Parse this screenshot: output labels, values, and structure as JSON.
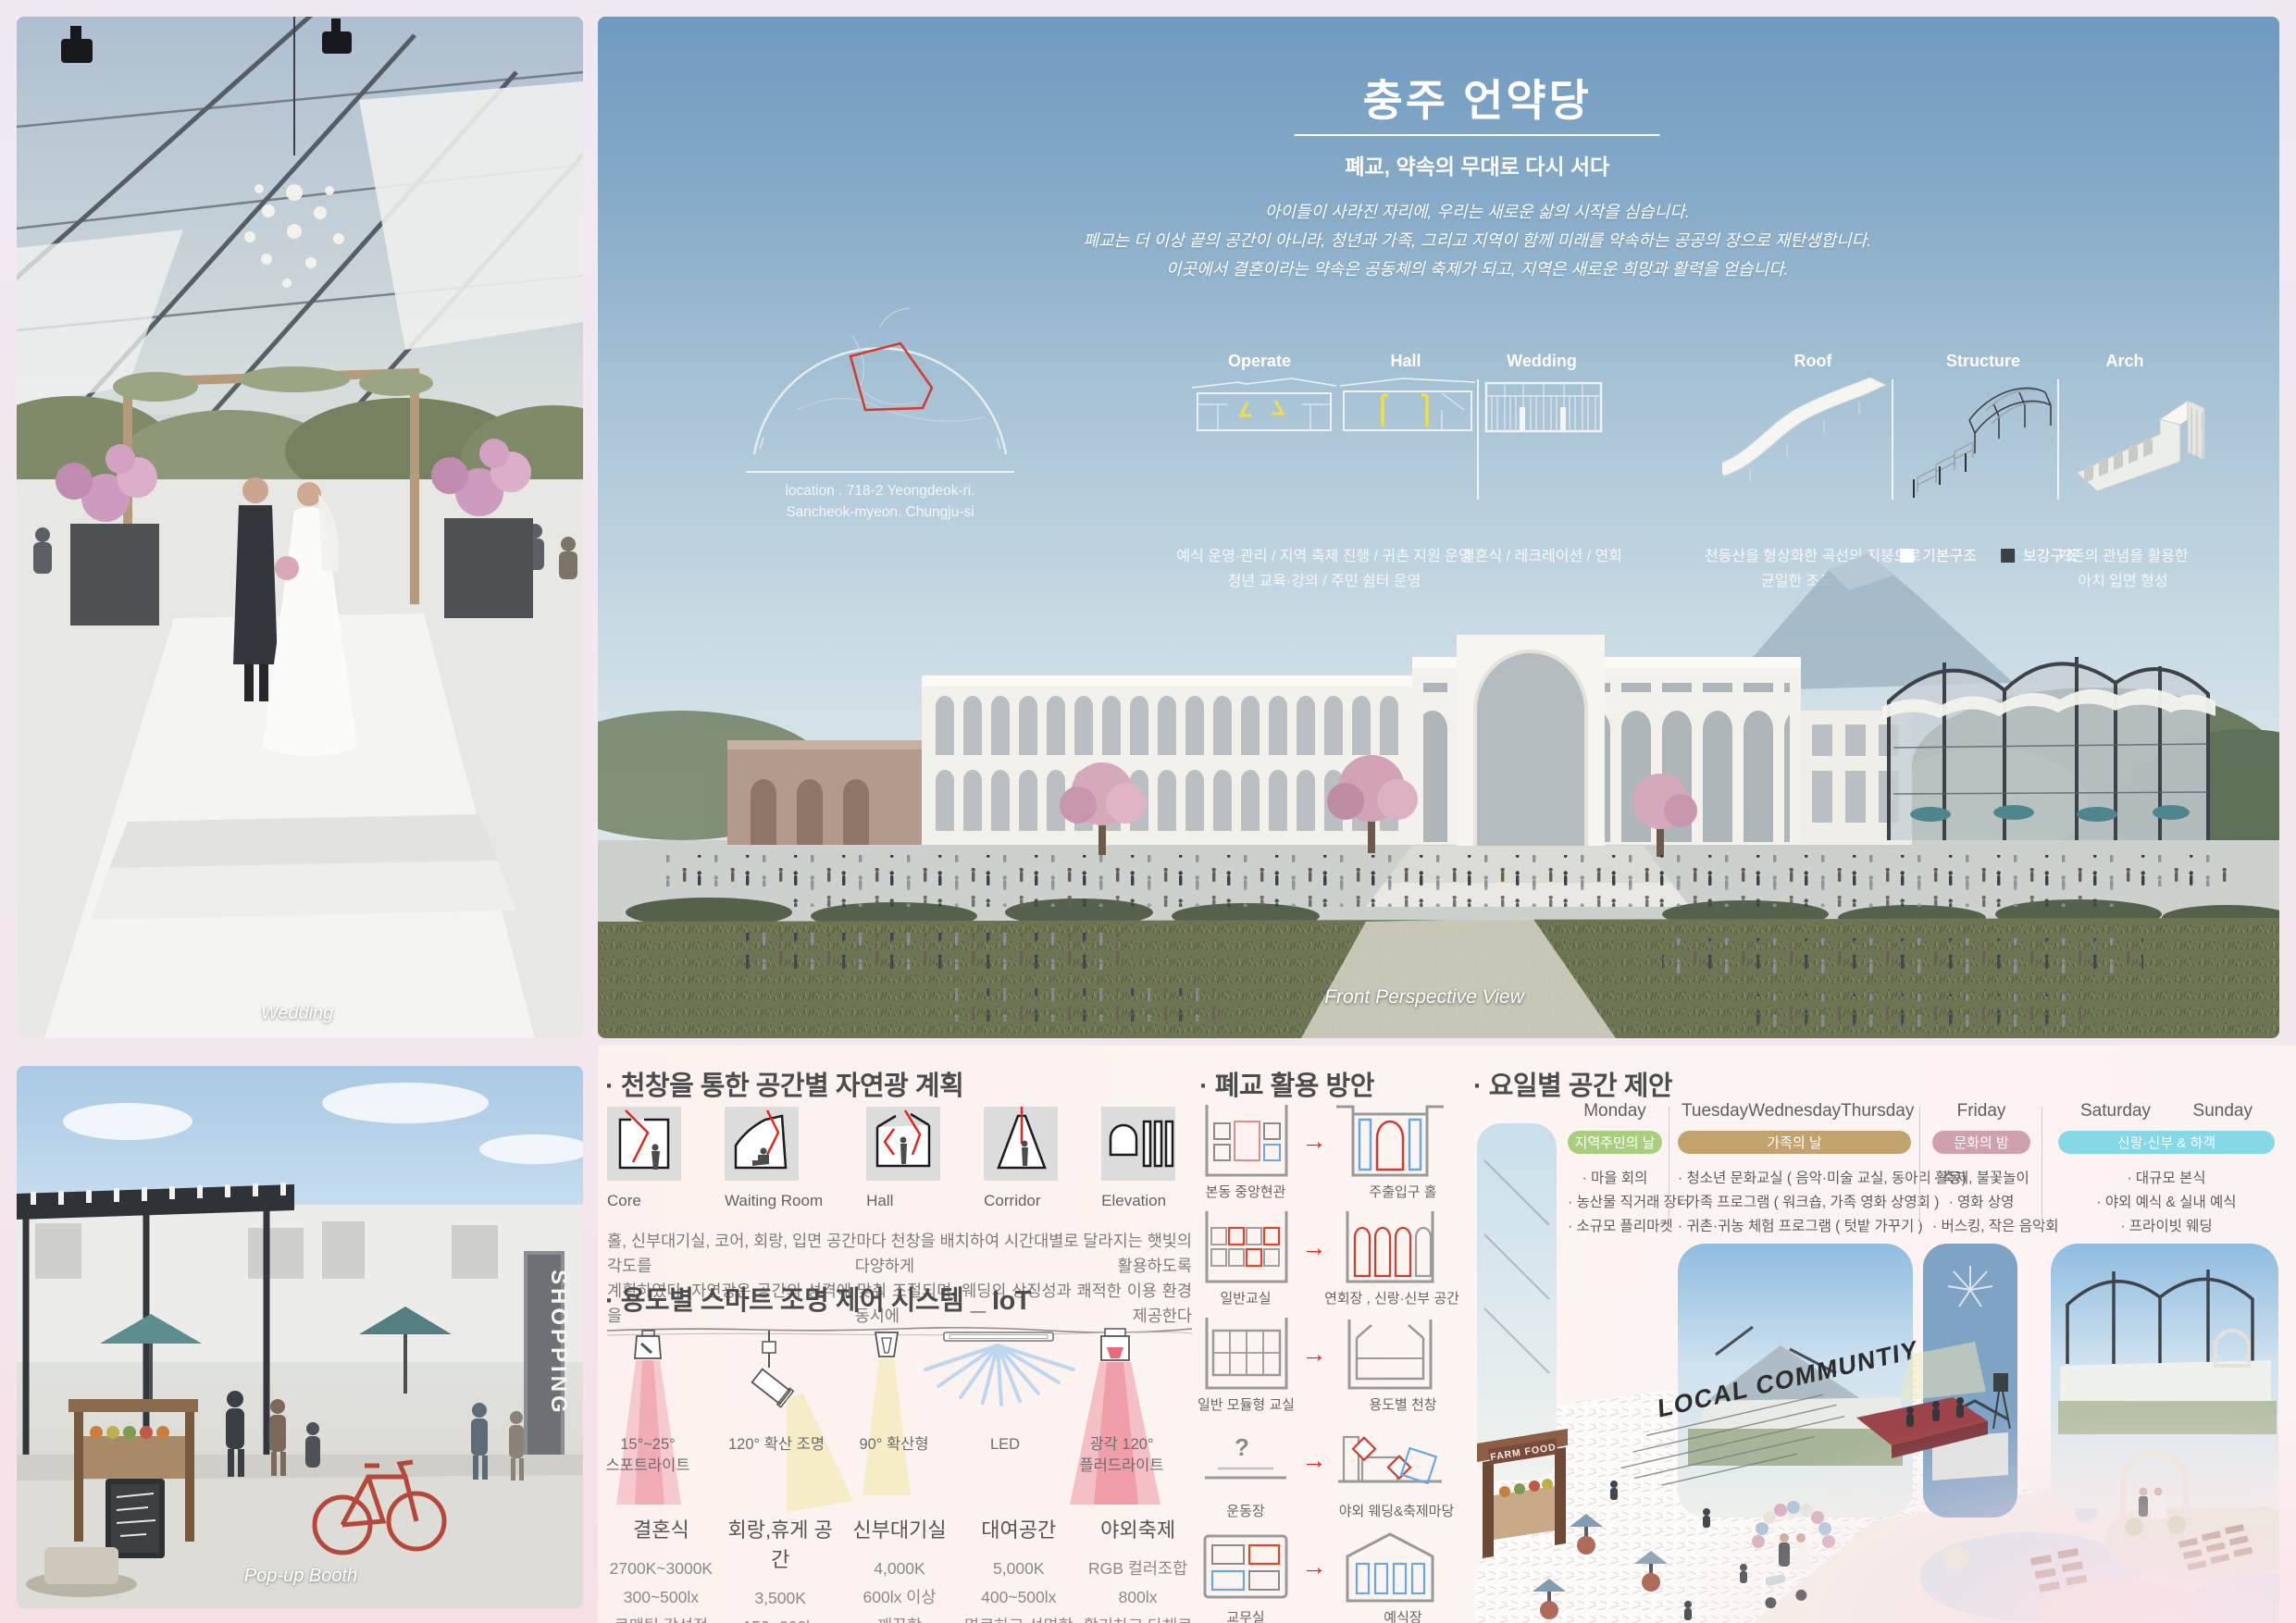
{
  "board": {
    "accent_colors": {
      "sky_blue": "#6f9ac0",
      "panel_pink": "#fcf1ee",
      "diagram_red": "#e8241c",
      "diagram_blue": "#6aa8e0",
      "highlight_yellow": "#f5e04a"
    }
  },
  "wedding_panel": {
    "caption": "Wedding"
  },
  "popup_panel": {
    "caption": "Pop-up Booth",
    "sign": "SHOPPING"
  },
  "hero": {
    "title": "충주 언약당",
    "subtitle": "폐교, 약속의 무대로 다시 서다",
    "intro": [
      "아이들이 사라진 자리에, 우리는 새로운 삶의 시작을 심습니다.",
      "폐교는 더 이상 끝의 공간이 아니라, 청년과 가족, 그리고 지역이 함께 미래를 약속하는 공공의 장으로 재탄생합니다.",
      "이곳에서 결혼이라는 약속은 공동체의 축제가 되고, 지역은 새로운 희망과 활력을 얻습니다."
    ],
    "location_line1": "location . 718-2 Yeongdeok-ri.",
    "location_line2": "Sancheok-myeon. Chungju-si",
    "program_labels": [
      "Operate",
      "Hall",
      "Wedding"
    ],
    "operate_hall_caption1": "예식 운영·관리 / 지역 축제 진행 / 귀촌 지원 운영",
    "operate_hall_caption2": "청년 교육·강의 / 주민 쉼터 운영",
    "wedding_caption": "결혼식 / 레크레이션 / 연회",
    "concept_labels": [
      "Roof",
      "Structure",
      "Arch"
    ],
    "roof_caption1": "천등산을 형상화한 곡선의 지붕으로",
    "roof_caption2": "균일한 조도 확보",
    "structure_legend": [
      "기본구조",
      "보강구조"
    ],
    "arch_caption1": "기존의 관념을 활용한",
    "arch_caption2": "아치 입면 형성",
    "view_caption": "Front Perspective View"
  },
  "daylight": {
    "heading": "· 천창을 통한 공간별 자연광 계획",
    "spaces": [
      "Core",
      "Waiting Room",
      "Hall",
      "Corridor",
      "Elevation"
    ],
    "para1": "홀, 신부대기실, 코어, 회랑, 입면 공간마다 천창을 배치하여 시간대별로 달라지는 햇빛의 각도를 다양하게 활용하도록",
    "para2": "계획하였다. 자연광은 공간의 성격에 맞춰 조절되며, 웨딩의 상징성과 쾌적한 이용 환경을 동시에 제공한다"
  },
  "iot": {
    "heading": "· 용도별 스마트 조명 제어 시스템 _ IoT",
    "fixtures": [
      {
        "line1": "15°~25°",
        "line2": "스포트라이트"
      },
      {
        "line1": "120° 확산 조명",
        "line2": ""
      },
      {
        "line1": "90° 확산형",
        "line2": ""
      },
      {
        "line1": "LED",
        "line2": ""
      },
      {
        "line1": "광각 120°",
        "line2": "플러드라이트"
      }
    ],
    "specs": [
      {
        "name": "결혼식",
        "temp": "2700K~3000K",
        "lux": "300~500lx",
        "mood": "로맨틱,감성적"
      },
      {
        "name": "회랑,휴게 공간",
        "temp": "3,500K",
        "lux": "150~200lx",
        "mood": "편안함"
      },
      {
        "name": "신부대기실",
        "temp": "4,000K",
        "lux": "600lx 이상",
        "mood": "깨끗함"
      },
      {
        "name": "대여공간",
        "temp": "5,000K",
        "lux": "400~500lx",
        "mood": "명료하고 선명함"
      },
      {
        "name": "야외축제",
        "temp": "RGB 컬러조합",
        "lux": "800lx",
        "mood": "활기차고 다채로움"
      }
    ]
  },
  "reuse": {
    "heading": "· 폐교 활용 방안",
    "rows": [
      {
        "from": "본동 중앙현관",
        "to": "주출입구 홀"
      },
      {
        "from": "일반교실",
        "to": "연회장 , 신랑·신부 공간"
      },
      {
        "from": "일반 모듈형 교실",
        "to": "용도별 천창"
      },
      {
        "from": "운동장",
        "to": "야외 웨딩&축제마당"
      },
      {
        "from": "교무실",
        "to": "예식장"
      }
    ]
  },
  "weekly": {
    "heading": "· 요일별 공간 제안",
    "columns": [
      {
        "days": [
          "Monday"
        ],
        "badge": "지역주민의 날",
        "badge_color": "#a9cf7e",
        "items": [
          "· 마을 회의",
          "· 농산물 직거래 장터",
          "· 소규모 플리마켓"
        ]
      },
      {
        "days": [
          "Tuesday",
          "Wednesday",
          "Thursday"
        ],
        "badge": "가족의 날",
        "badge_color": "#c2a36e",
        "items": [
          "· 청소년 문화교실 ( 음악·미술 교실,  동아리 활동)",
          "· 가족 프로그램 ( 워크숍, 가족 영화 상영회 )",
          "· 귀촌·귀농 체험 프로그램 ( 텃밭 가꾸기 )"
        ]
      },
      {
        "days": [
          "Friday"
        ],
        "badge": "문화의 밤",
        "badge_color": "#cfa0ae",
        "items": [
          "· 축제, 불꽃놀이",
          "· 영화 상영",
          "· 버스킹, 작은 음악회"
        ]
      },
      {
        "days": [
          "Saturday",
          "Sunday"
        ],
        "badge": "신랑·신부 & 하객",
        "badge_color": "#85d8e6",
        "items": [
          "· 대규모 본식",
          "· 야외 예식 & 실내 예식",
          "· 프라이빗 웨딩"
        ]
      }
    ],
    "ground_text": "LOCAL COMMUNTIY",
    "farm_sign": "FARM FOOD"
  }
}
